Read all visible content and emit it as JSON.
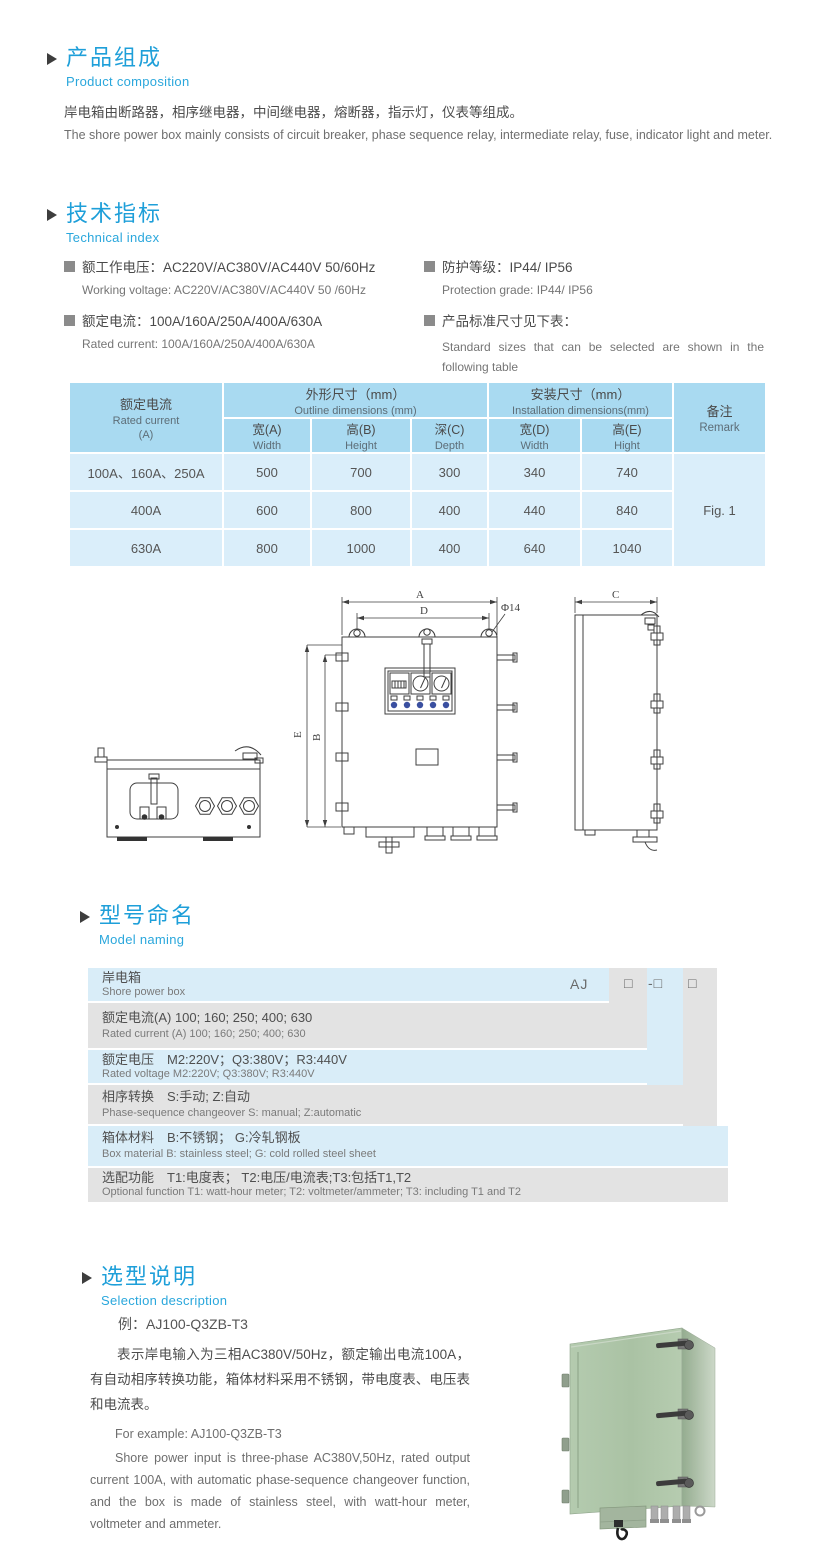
{
  "colors": {
    "title_blue": "#1e9fd9",
    "subtitle_blue": "#2aa7dc",
    "table_header_bg": "#a9daf1",
    "table_row_bg": "#daeefa",
    "band_blue": "#d9edf8",
    "band_gray": "#e3e3e3",
    "photo_green": "#aec5a9"
  },
  "composition": {
    "title_zh": "产品组成",
    "title_en": "Product  composition",
    "body_zh": "岸电箱由断路器，相序继电器，中间继电器，熔断器，指示灯，仪表等组成。",
    "body_en": "The shore power box mainly consists of circuit breaker, phase sequence relay, intermediate relay, fuse, indicator light and meter."
  },
  "technical": {
    "title_zh": "技术指标",
    "title_en": "Technical index",
    "items": [
      {
        "zh": "额工作电压：AC220V/AC380V/AC440V  50/60Hz",
        "en": "Working voltage: AC220V/AC380V/AC440V 50 /60Hz"
      },
      {
        "zh": "额定电流：100A/160A/250A/400A/630A",
        "en": "Rated current: 100A/160A/250A/400A/630A"
      },
      {
        "zh": "防护等级：IP44/ IP56",
        "en": "Protection grade: IP44/ IP56"
      },
      {
        "zh": "产品标准尺寸见下表：",
        "en": "Standard sizes that can be selected are shown in the following table"
      }
    ]
  },
  "size_table": {
    "col1_zh": "额定电流",
    "col1_en": "Rated current",
    "col1_unit": "(A)",
    "outline_zh": "外形尺寸（mm）",
    "outline_en": "Outline dimensions (mm)",
    "install_zh": "安装尺寸（mm）",
    "install_en": "Installation dimensions(mm)",
    "remark_zh": "备注",
    "remark_en": "Remark",
    "subcols": [
      {
        "zh": "宽(A)",
        "en": "Width"
      },
      {
        "zh": "高(B)",
        "en": "Height"
      },
      {
        "zh": "深(C)",
        "en": "Depth"
      },
      {
        "zh": "宽(D)",
        "en": "Width"
      },
      {
        "zh": "高(E)",
        "en": "Hight"
      }
    ],
    "rows": [
      [
        "100A、160A、250A",
        "500",
        "700",
        "300",
        "340",
        "740"
      ],
      [
        "400A",
        "600",
        "800",
        "400",
        "440",
        "840"
      ],
      [
        "630A",
        "800",
        "1000",
        "400",
        "640",
        "1040"
      ]
    ],
    "remark_value": "Fig. 1"
  },
  "drawing": {
    "labels": {
      "a": "A",
      "d": "D",
      "dia": "Φ14",
      "e": "E",
      "b": "B",
      "c": "C"
    }
  },
  "model_naming": {
    "title_zh": "型号命名",
    "title_en": "Model naming",
    "codes": [
      "AJ",
      "□",
      "-□",
      "□"
    ],
    "rows": [
      {
        "zh": "岸电箱",
        "en": "Shore power box"
      },
      {
        "zh": "额定电流(A)  100; 160; 250; 400; 630",
        "en": "Rated current (A) 100; 160; 250; 400; 630"
      },
      {
        "zh": "额定电压　M2:220V；Q3:380V；R3:440V",
        "en": "Rated voltage  M2:220V;  Q3:380V;  R3:440V"
      },
      {
        "zh": "相序转换　S:手动; Z:自动",
        "en": "Phase-sequence changeover  S: manual;  Z:automatic"
      },
      {
        "zh": "箱体材料　B:不锈钢； G:冷轧钢板",
        "en": "Box material   B: stainless steel; G: cold rolled steel sheet"
      },
      {
        "zh": "选配功能　T1:电度表； T2:电压/电流表;T3:包括T1,T2",
        "en": "Optional function  T1: watt-hour meter; T2: voltmeter/ammeter; T3: including T1 and T2"
      }
    ]
  },
  "selection": {
    "title_zh": "选型说明",
    "title_en": "Selection description",
    "example_zh": "例：AJ100-Q3ZB-T3",
    "body_zh": "表示岸电输入为三相AC380V/50Hz，额定输出电流100A，有自动相序转换功能，箱体材料采用不锈钢，带电度表、电压表和电流表。",
    "example_en": "For example: AJ100-Q3ZB-T3",
    "body_en": "Shore power input is three-phase AC380V,50Hz, rated output current 100A, with automatic phase-sequence changeover function, and the box is made of stainless steel, with watt-hour meter, voltmeter and ammeter."
  }
}
